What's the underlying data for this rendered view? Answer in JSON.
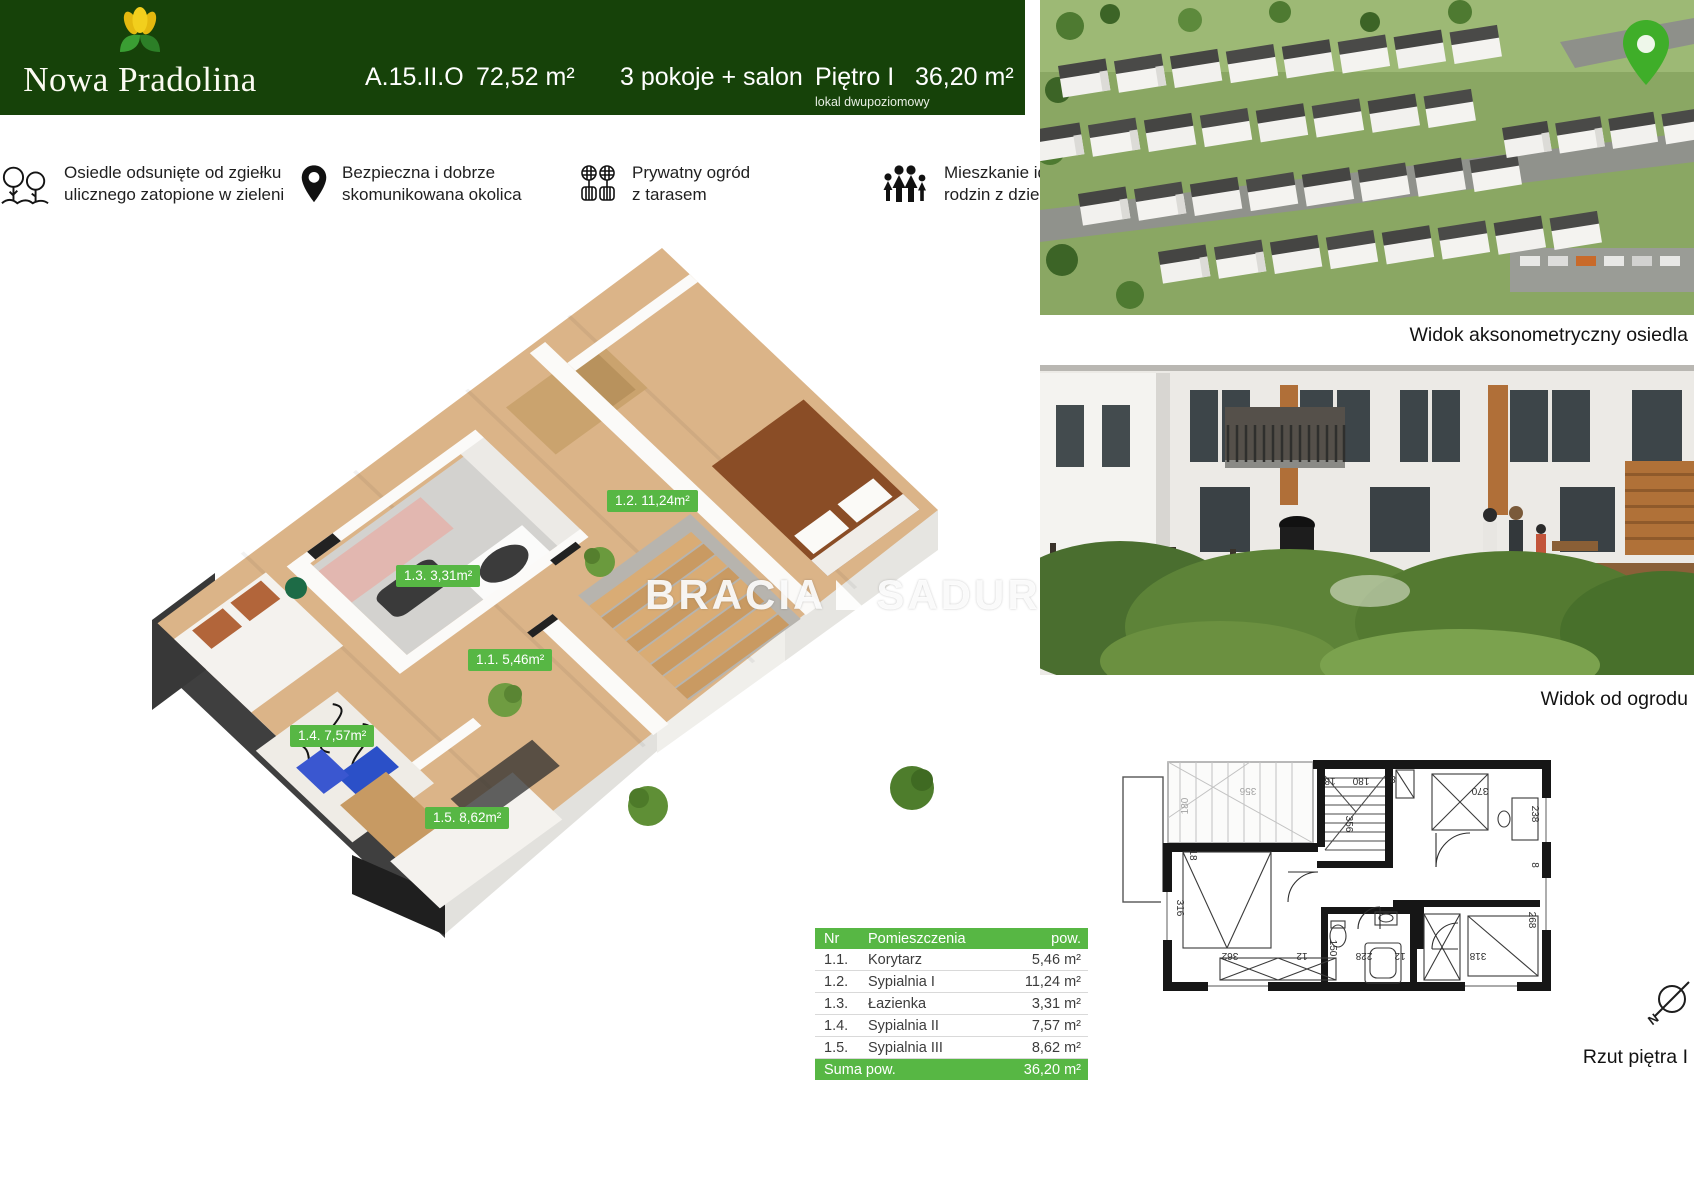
{
  "header": {
    "brand": "Nowa Pradolina",
    "unit_code": "A.15.II.O",
    "total_area": "72,52 m²",
    "layout": "3 pokoje + salon",
    "floor": "Piętro I",
    "floor_note": "lokal dwupoziomowy",
    "floor_area": "36,20 m²"
  },
  "features": [
    {
      "icon": "trees-icon",
      "text": "Osiedle odsunięte od zgiełku\nulicznego zatopione  w zieleni"
    },
    {
      "icon": "location-pin-icon",
      "text": "Bezpieczna i dobrze\nskomunikowana okolica"
    },
    {
      "icon": "garden-flowers-icon",
      "text": "Prywatny ogród\nz tarasem"
    },
    {
      "icon": "family-icon",
      "text": "Mieszkanie idealne dla\nrodzin z dziećmi"
    }
  ],
  "plan3d": {
    "watermark_left": "BRACIA",
    "watermark_right": "SADURS",
    "labels": [
      "1.2. 11,24m²",
      "1.3. 3,31m²",
      "1.1. 5,46m²",
      "1.4. 7,57m²",
      "1.5. 8,62m²"
    ]
  },
  "photos": {
    "aerial_caption": "Widok aksonometryczny osiedla",
    "garden_caption": "Widok od ogrodu"
  },
  "plan2d": {
    "caption": "Rzut piętra I",
    "compass_letter": "N",
    "dimensions": [
      "180",
      "356",
      "18",
      "180",
      "8",
      "370",
      "238",
      "356",
      "18",
      "316",
      "362",
      "12",
      "150",
      "228",
      "12",
      "318",
      "268",
      "8"
    ]
  },
  "table": {
    "col_nr": "Nr",
    "col_name": "Pomieszczenia",
    "col_area": "pow.",
    "rows": [
      {
        "nr": "1.1.",
        "name": "Korytarz",
        "area": "5,46 m²"
      },
      {
        "nr": "1.2.",
        "name": "Sypialnia I",
        "area": "11,24 m²"
      },
      {
        "nr": "1.3.",
        "name": "Łazienka",
        "area": "3,31 m²"
      },
      {
        "nr": "1.4.",
        "name": "Sypialnia II",
        "area": "7,57 m²"
      },
      {
        "nr": "1.5.",
        "name": "Sypialnia III",
        "area": "8,62 m²"
      }
    ],
    "total_label": "Suma pow.",
    "total_area": "36,20 m²"
  },
  "colors": {
    "header_green": "#164209",
    "accent_green": "#57b744",
    "pin_green": "#3fae29"
  }
}
